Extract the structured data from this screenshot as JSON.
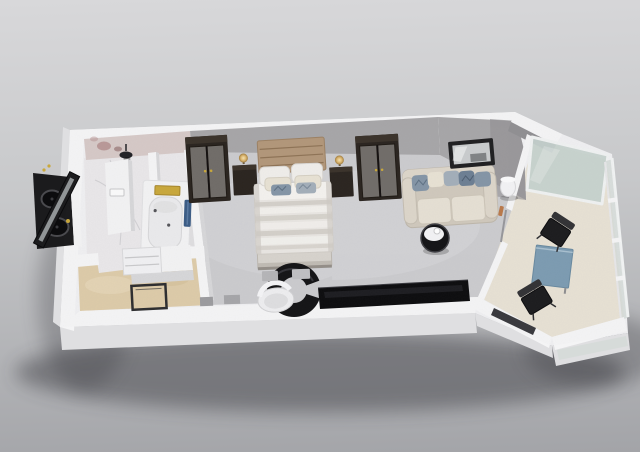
{
  "scene": {
    "type": "3d-floor-plan-render",
    "subject": "studio-suite-with-balcony",
    "view": "isometric-top-down"
  },
  "colors": {
    "bgTop": "#d8d8da",
    "bgMid": "#c7c8ca",
    "bgBottom": "#a3a4a8",
    "shadow": "#35353b",
    "slab": "#efeff1",
    "wallTop": "#f4f4f5",
    "wallFace": "#a7a6a8",
    "wallFaceDark": "#919093",
    "wallSide": "#dfdfe1",
    "wallShade": "#d7d7d9",
    "carpet": "#cbcbce",
    "carpetLight": "#d7d7d9",
    "marbleFloor": "#e9e7e9",
    "marbleWall": "#d6c9c7",
    "marbleSpotA": "#9b6a6a",
    "marbleSpotB": "#7c5454",
    "marbleSpotC": "#b28c8c",
    "entryFloor": "#ddcba9",
    "balconyFloor": "#e7e1d4",
    "glass": "#c6d1cd",
    "glassFrame": "#eff1f1",
    "railGlass": "#d5dad8",
    "doorGlassDark": "#3a3a3e",
    "woodDark": "#2b2520",
    "woodTop": "#3b332b",
    "doorPanel": "#716d69",
    "headboard": "#b2977a",
    "headboardLine": "#8e7356",
    "linen": "#e8e5e1",
    "linenFold": "#d3cfc9",
    "linenWhite": "#f3f1ee",
    "pillowWhite": "#efedea",
    "pillowCream": "#e7e1d3",
    "pillowBlue": "#8495a6",
    "pillowBlueDark": "#6d7f93",
    "pillowBlueLight": "#a3aeb9",
    "sofaBody": "#cfc8bc",
    "sofaArm": "#dcd5c9",
    "sofaCushion": "#e5dfd3",
    "mirrorFrame": "#202022",
    "mirrorGlass": "#c9cccd",
    "lampGlowA": "#f6e3b0",
    "lampGlowB": "#ddb872",
    "lampGlowC": "#a07c3e",
    "consoleBlack": "#0e0e10",
    "deskBlack": "#151517",
    "chairWhite": "#ededef",
    "tableBlue": "#7d9cb2",
    "chairBlack": "#1d1d1f",
    "towelBlue": "#3c5d86",
    "towelGold": "#c9a83c",
    "toiletWhite": "#f2f2f3",
    "vanityTop": "#1b1b1d",
    "sinkDark": "#0c0c0e"
  },
  "rooms": [
    {
      "id": "bathroom",
      "furniture": [
        "double-vanity",
        "twin-sinks",
        "leaning-mirror",
        "rain-shower-head",
        "toilet",
        "bathtub",
        "gold-towel",
        "blue-towel"
      ]
    },
    {
      "id": "entry-hall",
      "furniture": [
        "entry-door",
        "shoe-closet"
      ]
    },
    {
      "id": "bedroom",
      "furniture": [
        "wardrobe-left",
        "wardrobe-right",
        "headboard",
        "double-bed",
        "nightstand-left",
        "nightstand-right",
        "table-lamps",
        "curved-desk",
        "desk-chair",
        "media-console"
      ]
    },
    {
      "id": "living-area",
      "furniture": [
        "sofa",
        "throw-pillows",
        "wall-mirror",
        "floor-lamp",
        "round-side-table"
      ]
    },
    {
      "id": "balcony",
      "furniture": [
        "dining-table",
        "chair-upper",
        "chair-lower",
        "glass-partition",
        "glass-railing"
      ]
    }
  ]
}
